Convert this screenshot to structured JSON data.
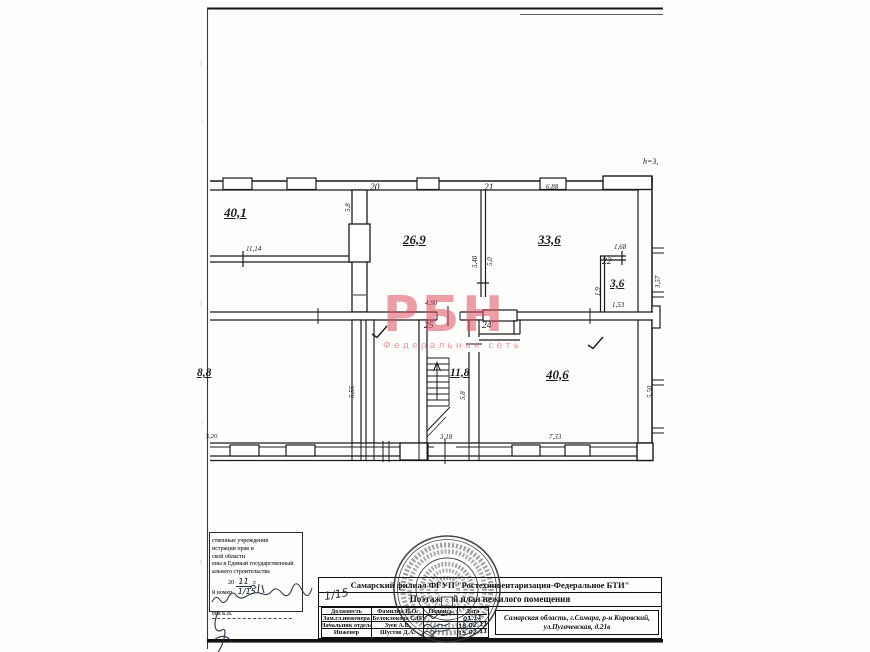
{
  "meta": {
    "height_note": "h=3,"
  },
  "watermark": {
    "text": "РБН",
    "subtext": "Федеральная сеть"
  },
  "plan": {
    "room_numbers": [
      "20",
      "21",
      "22",
      "25",
      "24"
    ],
    "room_areas": [
      "40,1",
      "26,9",
      "33,6",
      "3,6",
      "11,8",
      "40,6",
      "8,8"
    ],
    "dims": {
      "d11_14": "11,14",
      "d6_88": "6,88",
      "d5_8top": "5,8",
      "d5_40": "5,40",
      "d5_0": "5,0",
      "d1_68": "1,68",
      "d3_57": "3,57",
      "d1_9": "1,9",
      "d1_53": "1,53",
      "d4_90": "4,90",
      "d5_55": "5,55",
      "d5_8st": "5,8",
      "d5_50": "5,50",
      "d5_20": "5,20",
      "d3_18": "3,18",
      "d7_33": "7,33"
    }
  },
  "title_block": {
    "org": "Самарский филиал ФГУП \"Ростехинвентаризация-Федеральное БТИ\"",
    "doc_type": "Поэтажный план нежилого помещения",
    "address_line1": "Самарская область, г.Самара, р-н Кировский,",
    "address_line2": "ул.Пугачевская, д.21в",
    "headers": [
      "Должность",
      "Фамилия И.О.",
      "Подпись",
      "Дата"
    ],
    "rows": [
      {
        "position": "Зам.гл.инженера",
        "name": "Белоклокова С.Н.",
        "date": "01.11"
      },
      {
        "position": "Начальник отдела",
        "name": "Зуев А.В.",
        "date": "18.02.11"
      },
      {
        "position": "Инженер",
        "name": "Шустов Д.А.",
        "date": "15.02.11"
      }
    ]
  },
  "stamp": {
    "lines": [
      "ственные учреждения",
      "истрации прав и",
      "ской области",
      "ены в Единый государственный",
      "ального строительства"
    ],
    "year_prefix": "20",
    "year_value": "11",
    "year_suffix": "г.",
    "number_label": "й номер",
    "number_value": "1/15",
    "margin_note": "1/15",
    "signed": "ена  Б.В."
  },
  "seal": {
    "center_digit": "5"
  }
}
